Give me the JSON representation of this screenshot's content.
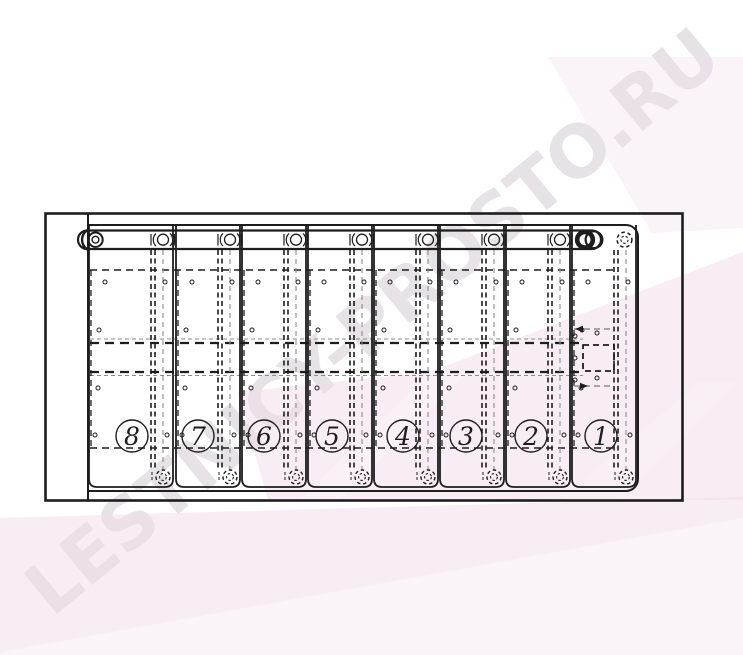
{
  "watermark": {
    "text": "LESTNICY-PROSTO.RU"
  },
  "drawing": {
    "steps": [
      {
        "label": "8"
      },
      {
        "label": "7"
      },
      {
        "label": "6"
      },
      {
        "label": "5"
      },
      {
        "label": "4"
      },
      {
        "label": "3"
      },
      {
        "label": "2"
      },
      {
        "label": "1"
      }
    ]
  },
  "colors": {
    "line": "#1d1d1d",
    "gray_line": "#8d8d8d",
    "pink": "#f2dcea",
    "watermark_gray": "#e6e2e5",
    "background": "#ffffff"
  }
}
